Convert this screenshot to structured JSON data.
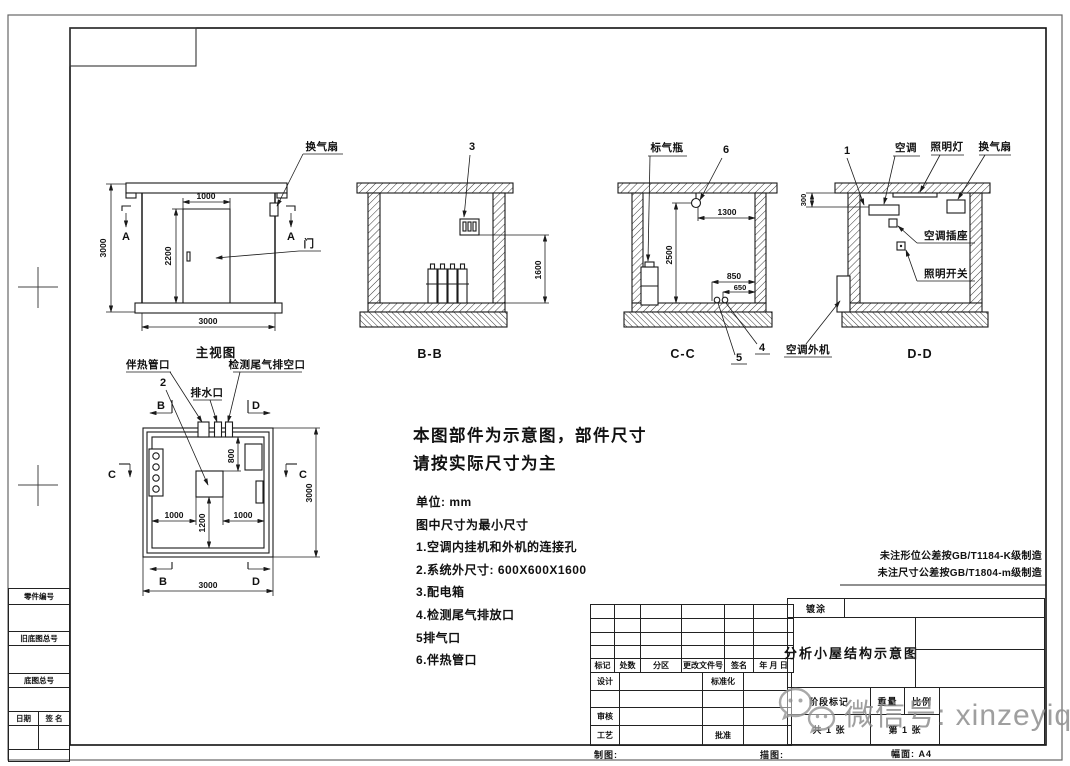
{
  "drawing": {
    "views": {
      "main": {
        "caption": "主视图",
        "label_fan": "换气扇",
        "label_door": "门",
        "section_letter": "A",
        "dim_height": "3000",
        "dim_door_width": "1000",
        "dim_door_height": "2200",
        "dim_width": "3000"
      },
      "section_bb": {
        "caption": "B-B",
        "callout_3": "3",
        "dim_1600": "1600"
      },
      "section_cc": {
        "caption": "C-C",
        "label_gas_bottle": "标气瓶",
        "callout_6": "6",
        "callout_4": "4",
        "callout_5": "5",
        "dim_1300": "1300",
        "dim_2500": "2500",
        "dim_850": "850",
        "dim_650": "650"
      },
      "section_dd": {
        "caption": "D-D",
        "callout_1": "1",
        "label_ac": "空调",
        "label_light": "照明灯",
        "label_fan": "换气扇",
        "label_ac_socket": "空调插座",
        "label_light_switch": "照明开关",
        "label_ac_outdoor": "空调外机",
        "dim_300": "300"
      },
      "plan": {
        "label_heat_trace_port": "伴热管口",
        "label_drain_port": "排水口",
        "label_exhaust_port": "检测尾气排空口",
        "callout_2": "2",
        "section_b": "B",
        "section_c": "C",
        "section_d": "D",
        "dim_800": "800",
        "dim_1000_left": "1000",
        "dim_1200": "1200",
        "dim_1000_right": "1000",
        "dim_3000_right": "3000",
        "dim_3000_bottom": "3000"
      }
    },
    "notes": {
      "headline_line1": "本图部件为示意图，部件尺寸",
      "headline_line2": "请按实际尺寸为主",
      "unit": "单位: mm",
      "min_size": "图中尺寸为最小尺寸",
      "items": [
        "1.空调内挂机和外机的连接孔",
        "2.系统外尺寸: 600X600X1600",
        "3.配电箱",
        "4.检测尾气排放口",
        "5排气口",
        "6.伴热管口"
      ]
    },
    "tolerance_notes": [
      "未注形位公差按GB/T1184-K级制造",
      "未注尺寸公差按GB/T1804-m级制造"
    ]
  },
  "title_block": {
    "coating": "镀涂",
    "title": "分析小屋结构示意图",
    "rev_headers": {
      "mark": "标记",
      "count": "处数",
      "zone": "分区",
      "doc_no": "更改文件号",
      "sign": "签名",
      "date": "年 月 日"
    },
    "design": "设计",
    "standardization": "标准化",
    "review": "审核",
    "process": "工艺",
    "approve": "批准",
    "stage_mark": "阶段标记",
    "weight": "重量",
    "scale": "比例",
    "total_sheets": "共 1 张",
    "sheet_no": "第 1 张"
  },
  "margin": {
    "part_no": "零件编号",
    "old_base_no": "旧底图总号",
    "base_no": "底图总号",
    "date": "日期",
    "sign": "签 名",
    "draft": "制图:",
    "trace": "描图:",
    "format": "幅面: A4"
  },
  "watermark": {
    "text": "微信号: xinzeyiqi"
  }
}
